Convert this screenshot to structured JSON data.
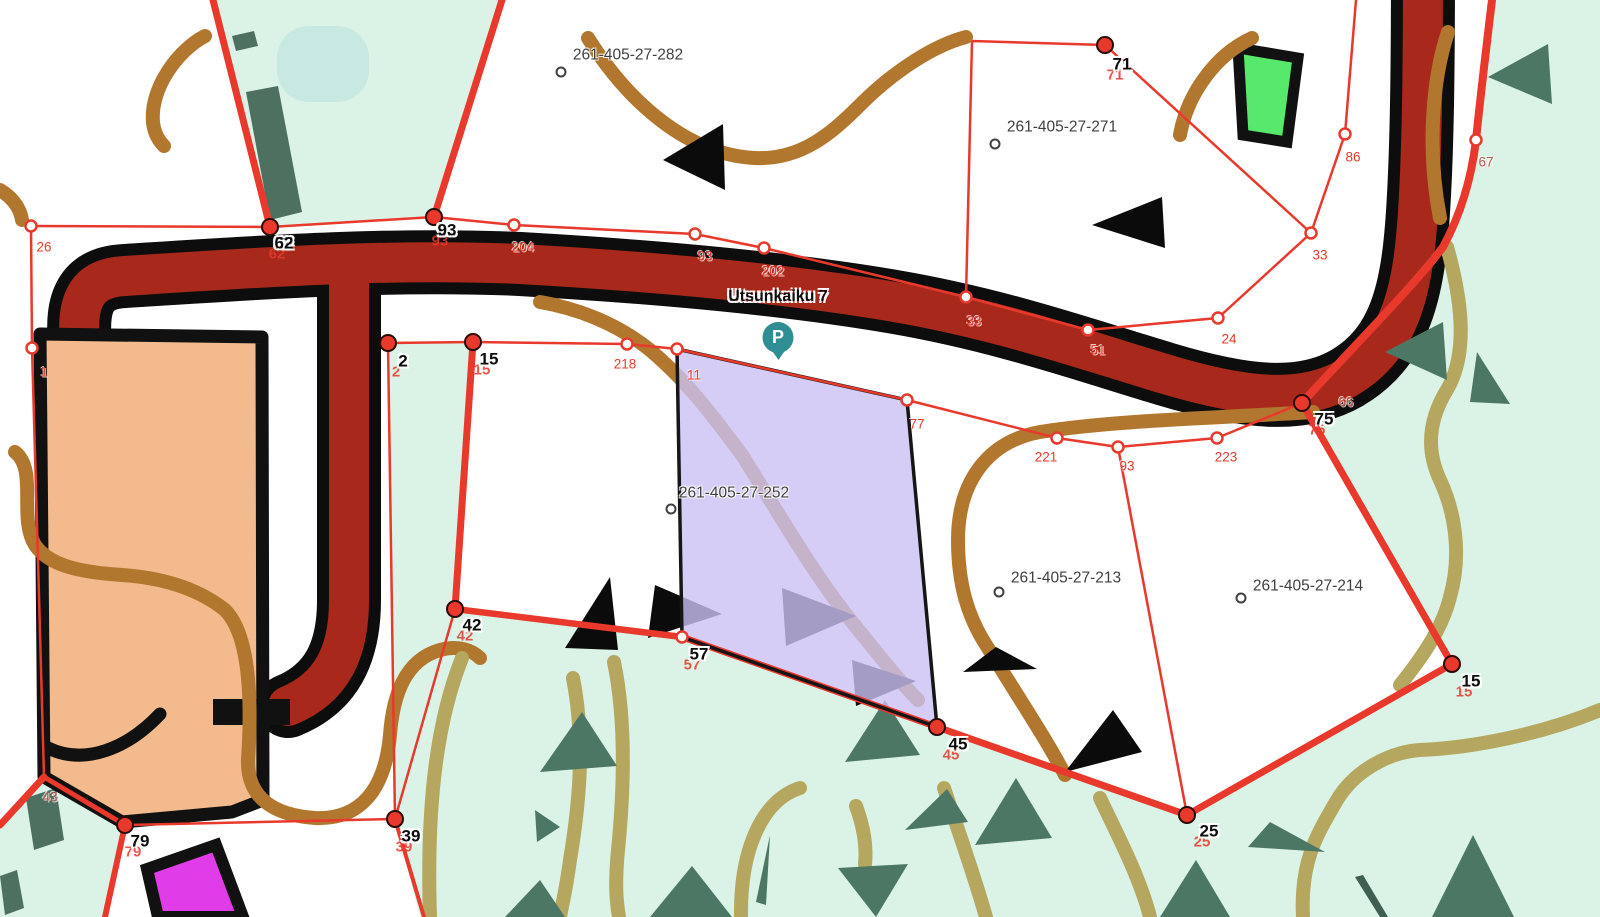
{
  "app": {
    "type": "cadastral-map-viewer"
  },
  "map": {
    "street": {
      "label": "Utsunkaiku 7",
      "x": 778,
      "y": 297
    },
    "pin": {
      "kind": "parking-marker",
      "letter": "P",
      "x": 778,
      "y": 340,
      "color": "#2f8e93"
    },
    "parcels": [
      {
        "id": "261-405-27-282",
        "label_x": 628,
        "label_y": 55,
        "marker_x": 561,
        "marker_y": 72
      },
      {
        "id": "261-405-27-271",
        "label_x": 1062,
        "label_y": 127,
        "marker_x": 995,
        "marker_y": 144
      },
      {
        "id": "261-405-27-252",
        "label_x": 734,
        "label_y": 493,
        "marker_x": 671,
        "marker_y": 509,
        "highlighted": true
      },
      {
        "id": "261-405-27-213",
        "label_x": 1066,
        "label_y": 578,
        "marker_x": 999,
        "marker_y": 592
      },
      {
        "id": "261-405-27-214",
        "label_x": 1308,
        "label_y": 586,
        "marker_x": 1241,
        "marker_y": 598
      }
    ],
    "vertex_labels": [
      {
        "text": "62",
        "x": 284,
        "y": 243
      },
      {
        "text": "93",
        "x": 447,
        "y": 230
      },
      {
        "text": "71",
        "x": 1122,
        "y": 64
      },
      {
        "text": "2",
        "x": 403,
        "y": 361
      },
      {
        "text": "15",
        "x": 489,
        "y": 359
      },
      {
        "text": "42",
        "x": 472,
        "y": 625
      },
      {
        "text": "57",
        "x": 699,
        "y": 654
      },
      {
        "text": "45",
        "x": 958,
        "y": 744
      },
      {
        "text": "75",
        "x": 1324,
        "y": 419
      },
      {
        "text": "25",
        "x": 1209,
        "y": 831
      },
      {
        "text": "15",
        "x": 1471,
        "y": 681
      },
      {
        "text": "39",
        "x": 411,
        "y": 836
      },
      {
        "text": "79",
        "x": 140,
        "y": 841
      }
    ],
    "measure_labels": [
      {
        "text": "26",
        "x": 44,
        "y": 247
      },
      {
        "text": "204",
        "x": 523,
        "y": 247
      },
      {
        "text": "93",
        "x": 705,
        "y": 256
      },
      {
        "text": "202",
        "x": 773,
        "y": 271
      },
      {
        "text": "33",
        "x": 974,
        "y": 321
      },
      {
        "text": "51",
        "x": 1098,
        "y": 350
      },
      {
        "text": "24",
        "x": 1229,
        "y": 339
      },
      {
        "text": "33",
        "x": 1320,
        "y": 255
      },
      {
        "text": "86",
        "x": 1353,
        "y": 157
      },
      {
        "text": "67",
        "x": 1486,
        "y": 162,
        "color": "#c05549"
      },
      {
        "text": "218",
        "x": 625,
        "y": 364
      },
      {
        "text": "11",
        "x": 694,
        "y": 375
      },
      {
        "text": "77",
        "x": 917,
        "y": 424
      },
      {
        "text": "221",
        "x": 1046,
        "y": 457
      },
      {
        "text": "93",
        "x": 1127,
        "y": 466
      },
      {
        "text": "223",
        "x": 1226,
        "y": 457
      },
      {
        "text": "66",
        "x": 1346,
        "y": 402,
        "color": "#c05549"
      },
      {
        "text": "43",
        "x": 50,
        "y": 797,
        "color": "#b0554a"
      },
      {
        "text": "1",
        "x": 44,
        "y": 372
      }
    ],
    "colors": {
      "forest_mint": "#daf3e6",
      "water_aqua": "#c7e9e1",
      "road_fill": "#a8291b",
      "road_casing": "#0d0d0d",
      "boundary_red": "#e8392c",
      "contour_brown": "#b1772e",
      "path_olive": "#b5a75f",
      "tree_symbol_green": "#4d7765",
      "vegetation_rect_green": "#4e7061",
      "building_orange": "#f3bb8d",
      "building_green": "#57e96b",
      "building_magenta": "#e03ce8",
      "selected_parcel_purple": "rgba(203,192,242,0.8)",
      "pin_teal": "#2f8e93",
      "parcel_label_gray": "#3f3f3f"
    }
  }
}
